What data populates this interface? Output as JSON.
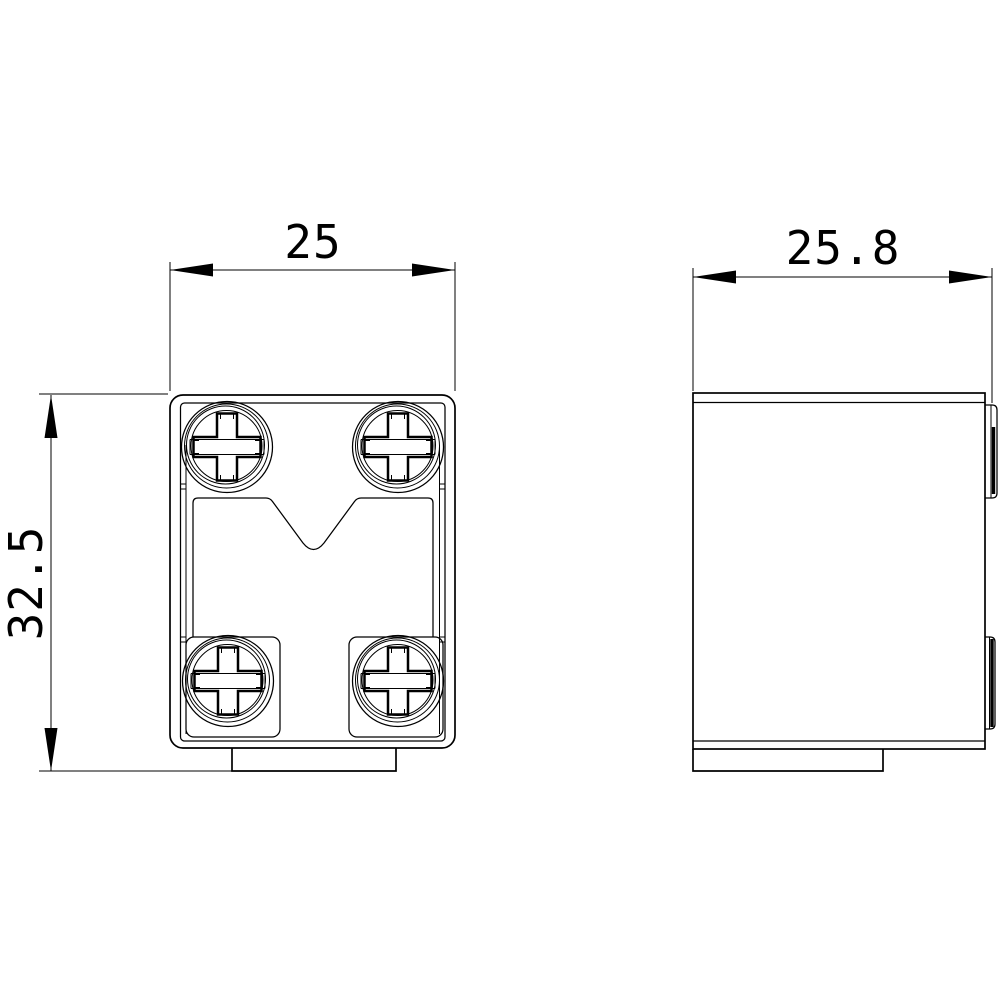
{
  "drawing": {
    "views": {
      "front": {
        "description": "front view with four phillips screws"
      },
      "side": {
        "description": "side view with mounting clips"
      }
    },
    "dimensions": {
      "front_width": "25",
      "side_width": "25.8",
      "front_height": "32.5"
    },
    "colors": {
      "line": "#000000",
      "background": "#ffffff"
    }
  }
}
